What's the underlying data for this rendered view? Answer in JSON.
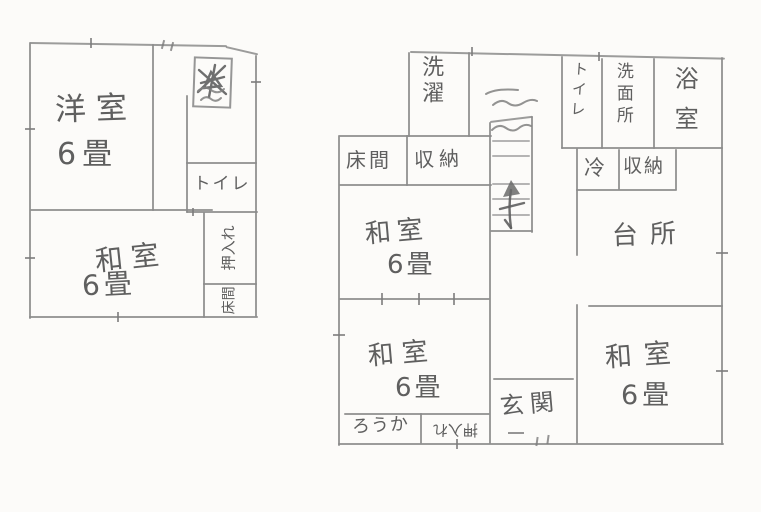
{
  "document_type": "hand-drawn floor plan",
  "colors": {
    "line": "#8b8b8b",
    "text": "#4a4a4a",
    "background": "#fcfbf9"
  },
  "left_plan": {
    "western_room": {
      "name": "洋室",
      "size": "6畳"
    },
    "toilet": {
      "name": "トイレ"
    },
    "japanese_room": {
      "name": "和室",
      "size": "6畳"
    },
    "closet": {
      "name": "押入れ"
    },
    "alcove": {
      "name": "床間"
    }
  },
  "right_plan": {
    "laundry": {
      "name": "洗濯"
    },
    "alcove": {
      "name": "床間"
    },
    "storage_upper": {
      "name": "収納"
    },
    "toilet": {
      "name": "トイレ"
    },
    "washroom": {
      "name": "洗面所"
    },
    "bathroom": {
      "name": "浴室"
    },
    "refrigerator": {
      "name": "冷"
    },
    "storage_kitchen": {
      "name": "収納"
    },
    "kitchen": {
      "name": "台所"
    },
    "japanese_room_center": {
      "name": "和室",
      "size": "6畳"
    },
    "japanese_room_lower": {
      "name": "和室",
      "size": "6畳"
    },
    "japanese_room_right": {
      "name": "和室",
      "size": "6畳"
    },
    "entrance": {
      "name": "玄関"
    },
    "corridor": {
      "name": "ろうか"
    },
    "closet": {
      "name": "押入れ"
    }
  }
}
